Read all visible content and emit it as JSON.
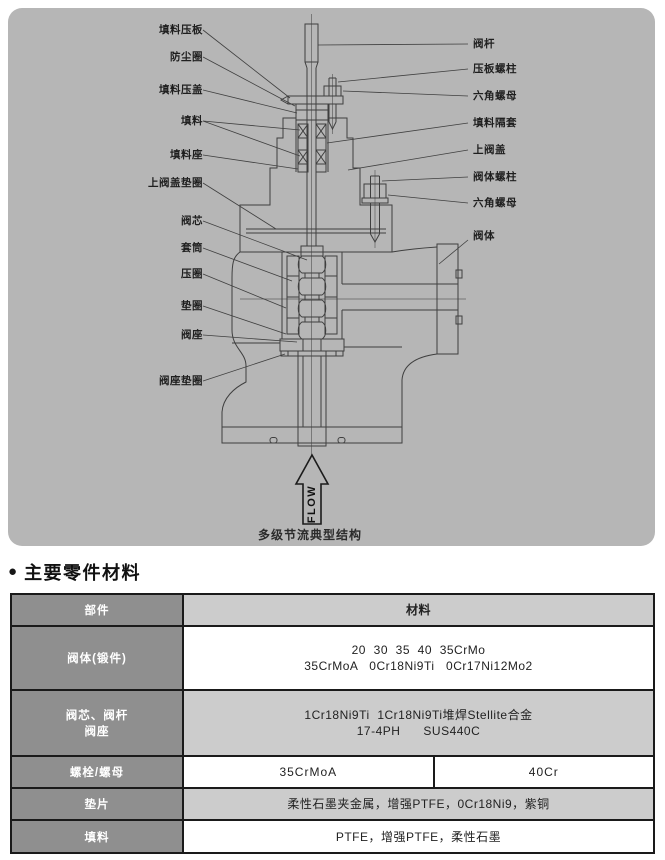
{
  "colors": {
    "panel_gray": "#b6b6b6",
    "drawing_line": "#3f3f3f",
    "table_dark_cell": "#8f8f8f",
    "table_light_cell": "#cccccc",
    "table_border": "#1a1a1a"
  },
  "diagram": {
    "caption": "多级节流典型结构",
    "flow_label": "FLOW",
    "left_labels": [
      "填料压板",
      "防尘圈",
      "填料压盖",
      "填料",
      "填料座",
      "上阀盖垫圈",
      "阀芯",
      "套筒",
      "压圈",
      "垫圈",
      "阀座",
      "阀座垫圈"
    ],
    "right_labels": [
      "阀杆",
      "压板螺柱",
      "六角螺母",
      "填料隔套",
      "上阀盖",
      "阀体螺柱",
      "六角螺母",
      "阀体"
    ]
  },
  "section": {
    "bullet": "●",
    "title": "主要零件材料"
  },
  "table": {
    "header": {
      "part": "部件",
      "material": "材料"
    },
    "rows": {
      "body": {
        "part": "阀体(锻件)",
        "material_line1": "20  30  35  40  35CrMo",
        "material_line2": "35CrMoA   0Cr18Ni9Ti   0Cr17Ni12Mo2"
      },
      "trim": {
        "part_line1": "阀芯、阀杆",
        "part_line2": "阀座",
        "material_line1": "1Cr18Ni9Ti  1Cr18Ni9Ti堆焊Stellite合金",
        "material_line2": "17-4PH      SUS440C"
      },
      "bolt": {
        "part": "螺栓/螺母",
        "material_left": "35CrMoA",
        "material_right": "40Cr"
      },
      "gasket": {
        "part": "垫片",
        "material": "柔性石墨夹金属，增强PTFE，0Cr18Ni9，紫铜"
      },
      "packing": {
        "part": "填料",
        "material": "PTFE，增强PTFE，柔性石墨"
      }
    }
  }
}
